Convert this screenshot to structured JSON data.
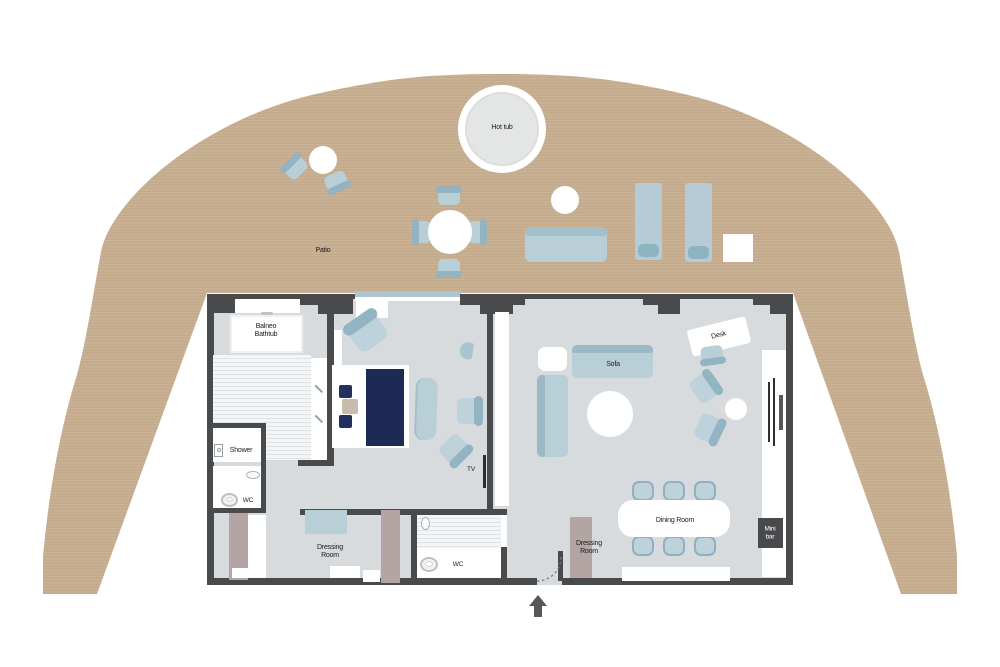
{
  "title": "Suite floor plan",
  "labels": {
    "patio": "Patio",
    "hot_tub": "Hot tub",
    "balneo": {
      "l1": "Balneo",
      "l2": "Bathtub"
    },
    "shower": "Shower",
    "wc_bath": "WC",
    "wc_guest": "WC",
    "dressing_main": {
      "l1": "Dressing",
      "l2": "Room"
    },
    "dressing_entry": {
      "l1": "Dressing",
      "l2": "Room"
    },
    "tv": "TV",
    "sofa": "Sofa",
    "desk": "Desk",
    "dining": "Dining Room",
    "minibar": {
      "l1": "Mini",
      "l2": "bar"
    }
  },
  "colors": {
    "deck": "#cab294",
    "deck_stripe": "#bfa687",
    "floor": "#d8dbde",
    "wall": "#494a4c",
    "furniture_blue": "#b9cfd8",
    "furniture_blue_dark": "#93b4c3",
    "bed_navy": "#1d2a55",
    "wardrobe_mauve": "#b2a5a3",
    "minibar_bg": "#48494b",
    "glazing": "#aec5d0"
  }
}
